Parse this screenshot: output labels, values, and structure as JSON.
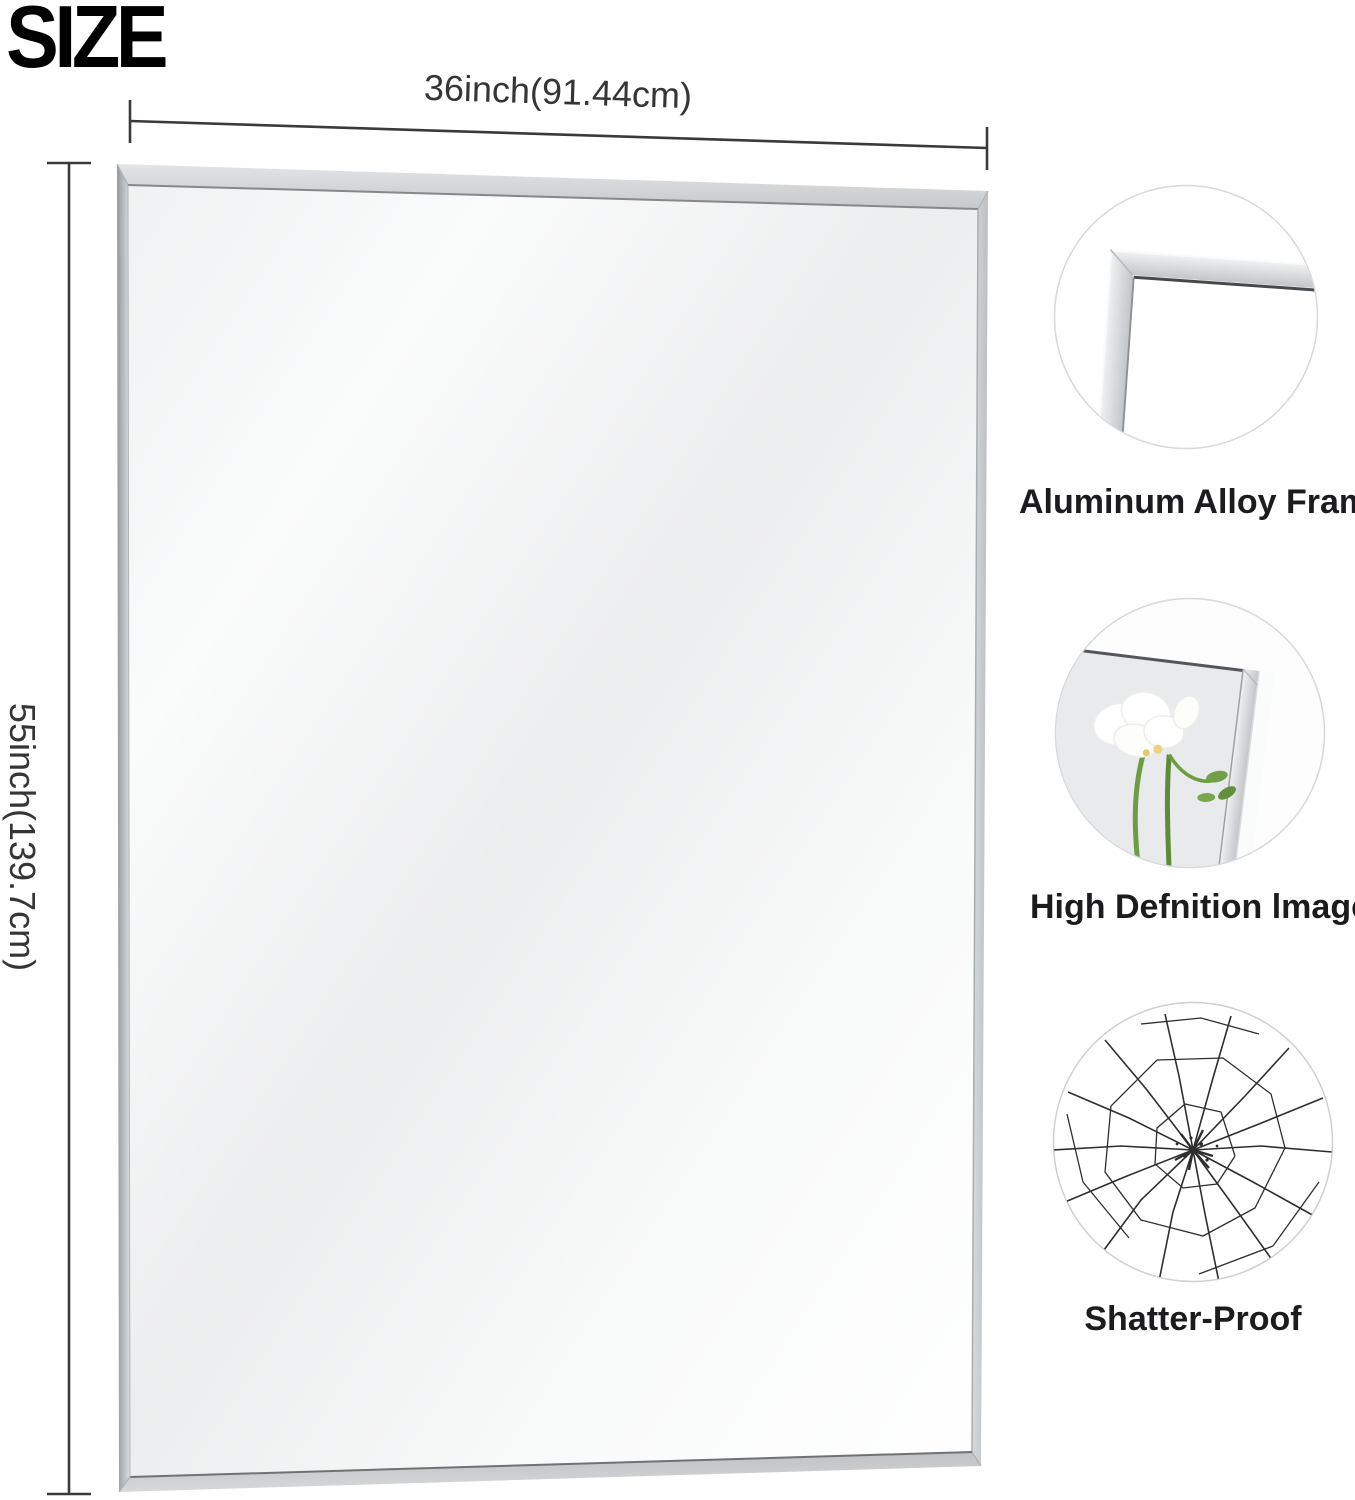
{
  "title": "SIZE",
  "mirror": {
    "width_label": "36inch(91.44cm)",
    "height_label": "55inch(139.7cm)"
  },
  "features": [
    {
      "caption": "Aluminum Alloy Frame",
      "icon": "frame-corner-icon"
    },
    {
      "caption": "High Defnition lmage",
      "icon": "flower-reflection-icon"
    },
    {
      "caption": "Shatter-Proof",
      "icon": "shattered-glass-icon"
    }
  ],
  "colors": {
    "background": "#ffffff",
    "frame_silver": "#c7cacc",
    "mirror_tint": "#eceeef",
    "dimension_line": "#3a3a3a",
    "text_dark": "#1c1c1e"
  }
}
